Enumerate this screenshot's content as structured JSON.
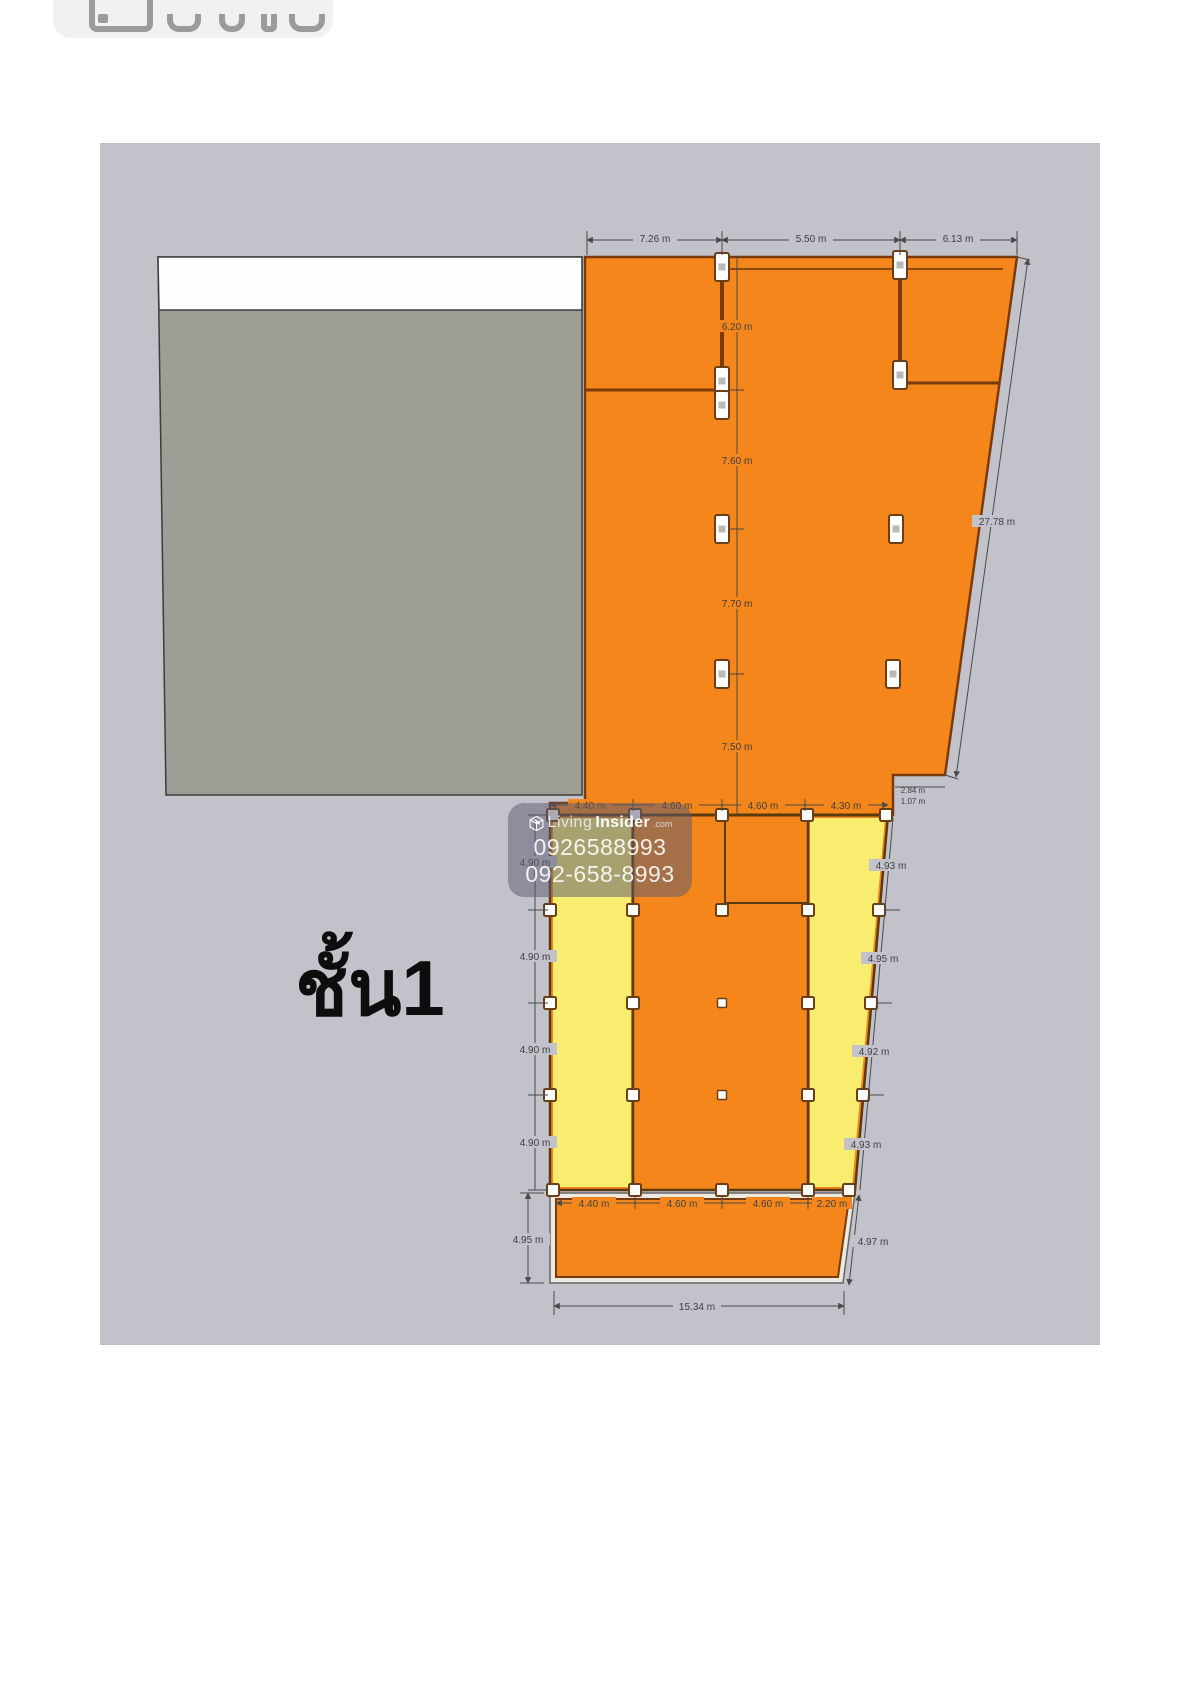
{
  "toolbar": {
    "button_icon": "image-icon"
  },
  "floor_plan": {
    "floor_label": "ชั้น1",
    "watermark": {
      "brand_light": "Living",
      "brand_bold": "Insider",
      "brand_suffix": ".com",
      "phone_line1": "0926588993",
      "phone_line2": "092-658-8993"
    },
    "dims": {
      "top_chain": [
        "7.26 m",
        "5.50 m",
        "6.13 m"
      ],
      "center_vertical": [
        "6.20 m",
        "7.60 m",
        "7.70 m",
        "7.50 m"
      ],
      "right_slant": "27.78 m",
      "step": [
        "2.84 m",
        "1.07 m"
      ],
      "mid_chain": [
        "4.40 m",
        "4.60 m",
        "4.60 m",
        "4.30 m"
      ],
      "lower_left": [
        "4.90 m",
        "4.90 m",
        "4.90 m",
        "4.90 m"
      ],
      "lower_right": [
        "4.93 m",
        "4.95 m",
        "4.92 m",
        "4.93 m"
      ],
      "strip_chain": [
        "4.40 m",
        "4.60 m",
        "4.60 m",
        "2.20 m"
      ],
      "strip_left": "4.95 m",
      "strip_right": "4.97 m",
      "overall_bottom": "15.34 m"
    },
    "colors": {
      "canvas_bg": "#c2c2cb",
      "orange": "#f5861b",
      "yellow": "#f8ed6e",
      "block_gray": "#9e9e97",
      "white_band": "#fdfdfd",
      "wall_brown": "#7a3a0e",
      "dim_gray": "#3f3f3f"
    }
  }
}
